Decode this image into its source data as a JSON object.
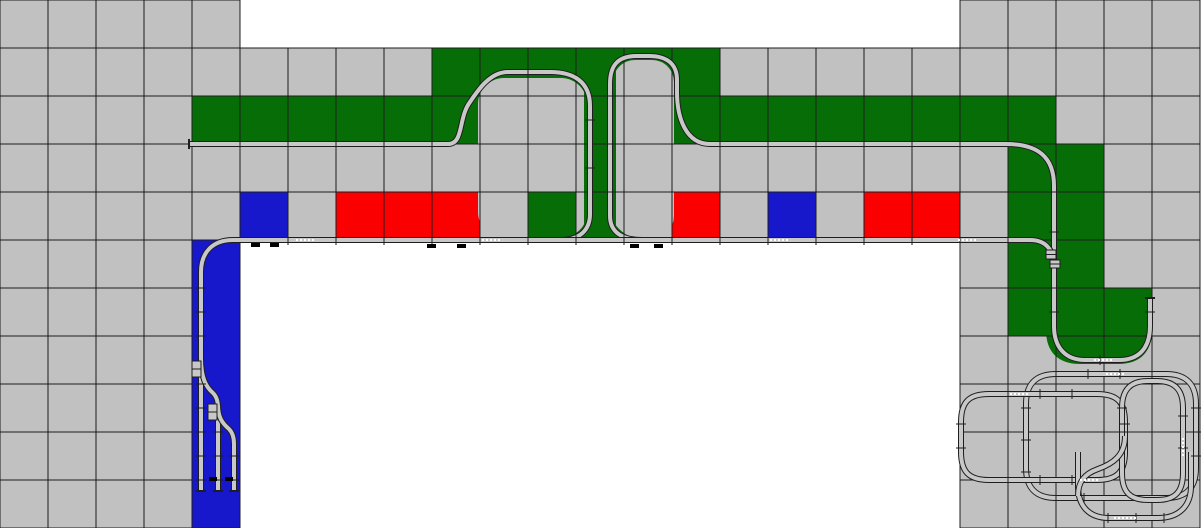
{
  "canvas": {
    "width": 1201,
    "height": 528,
    "cell_size": 48,
    "cols": 25,
    "rows": 11
  },
  "palette": {
    "gray": "#c1c1c1",
    "green": "#076e07",
    "red": "#fa0000",
    "blue": "#1717cc",
    "white": "#ffffff",
    "grid_line": "#1d1d1d",
    "track_dark": "#1e1e1e",
    "track_light": "#c8c8c8",
    "mark_black": "#000000",
    "joint_white": "#ffffff"
  },
  "legend": {
    "G": "gray",
    "N": "green",
    "R": "red",
    "B": "blue",
    "W": "white"
  },
  "grid": [
    "GGGGGWWWWWWWWWWWWWWWGGGGG",
    "GGGGGGGGGNNNNNNGGGGGGGGGG",
    "GGGGNNNNNNGGNNNNNNNNNNGGG",
    "GGGGGGGGGGGGNGGGGGGGGNNGG",
    "GGGGGBGRRRGNNGRGBGRRGNNGG",
    "GGGGBWWWWWWWWWWWWWWWGNNGG",
    "GGGGBWWWWWWWWWWWWWWWGNNNG",
    "GGGGBWWWWWWWWWWWWWWWGGGGG",
    "GGGGBWWWWWWWWWWWWWWWGGGGG",
    "GGGGBWWWWWWWWWWWWWWWGGGGG",
    "GGGGBWWWWWWWWWWWWWWWGGGGG"
  ],
  "overlays": [
    {
      "kind": "rrect",
      "name": "left-loop-interior",
      "x": 478,
      "y": 78,
      "w": 109,
      "h": 160,
      "r": 26,
      "color": "gray"
    },
    {
      "kind": "rrect",
      "name": "right-loop-interior",
      "x": 613,
      "y": 60,
      "w": 61,
      "h": 178,
      "r": 22,
      "color": "gray"
    },
    {
      "kind": "rect",
      "name": "center-green-strip",
      "x": 584,
      "y": 48,
      "w": 32,
      "h": 193,
      "color": "green"
    },
    {
      "kind": "path",
      "name": "funnel-wedge-left",
      "d": "M590,212 C588,224 578,235 560,241 L590,241 Z",
      "color": "green"
    },
    {
      "kind": "path",
      "name": "funnel-wedge-right",
      "d": "M610,212 C612,224 622,235 640,241 L610,241 Z",
      "color": "green"
    },
    {
      "kind": "rect",
      "name": "green-pad-cell",
      "x": 528,
      "y": 192,
      "w": 48,
      "h": 48,
      "color": "green"
    },
    {
      "kind": "path",
      "name": "right-u-green-fill",
      "d": "M1046,288 L1152,288 L1152,330 C1152,352 1140,364 1118,364 L1080,364 C1058,364 1046,352 1046,330 Z",
      "color": "green"
    }
  ],
  "blue_column": {
    "x": 192,
    "y": 240,
    "w": 48,
    "h": 288
  },
  "tracks": [
    {
      "name": "practice-oval-a",
      "d": "M1056,374 L1166,374 C1186,374 1196,384 1196,404 L1196,468 C1196,488 1186,498 1166,498 L1056,498 C1036,498 1026,488 1026,468 L1026,404 C1026,384 1036,374 1056,374 Z"
    },
    {
      "name": "practice-oval-b",
      "d": "M989,394 L1097,394 C1117,394 1125,402 1125,422 L1125,452 C1125,472 1117,480 1097,480 L989,480 C969,480 961,472 961,452 L961,422 C961,402 969,394 989,394 Z"
    },
    {
      "name": "practice-oval-c",
      "d": "M1148,381 L1157,381 C1175,381 1183,390 1183,408 L1183,473 C1183,492 1175,500 1157,500 L1148,500 C1130,500 1122,492 1122,473 L1122,408 C1122,390 1130,381 1148,381 Z"
    },
    {
      "name": "practice-loop-bottom",
      "d": "M1078,452 L1078,486 C1078,506 1089,518 1109,518 L1158,518 C1179,518 1191,506 1191,486 L1191,452"
    },
    {
      "name": "practice-s-curve",
      "d": "M1125,436 C1125,456 1112,464 1098,469 C1084,474 1078,482 1078,496"
    },
    {
      "name": "upper-line-left-loop",
      "d": "M189,144 L448,144 C464,144 458,118 470,102 C478,90 490,72 508,72 L550,72 C574,72 590,82 590,106 L590,214 C590,230 580,240 560,240"
    },
    {
      "name": "upper-line-right-loop",
      "d": "M642,240 C622,240 610,232 610,216 L610,84 C610,64 619,56 637,56 L649,56 C668,56 677,65 677,80 L677,92 C677,118 686,144 710,144 L1006,144 C1038,144 1054,157 1054,186 L1054,326 C1054,348 1066,360 1085,360 L1119,360 C1139,360 1150,348 1150,326 L1150,298"
    },
    {
      "name": "main-line",
      "d": "M233,240 L1030,240 C1046,240 1054,250 1054,267"
    },
    {
      "name": "siding-stub-1",
      "d": "M233,240 C213,240 201,252 201,272 L201,491"
    },
    {
      "name": "siding-stub-2",
      "d": "M201,358 C201,378 206,387 213,393 C217,397 218,402 218,409 L218,491"
    },
    {
      "name": "siding-stub-3",
      "d": "M218,405 C218,417 222,423 229,429 C233,433 234,438 234,444 L234,491"
    }
  ],
  "ticks": [
    {
      "o": "v",
      "y": 144,
      "xs": [
        240,
        288,
        336,
        384,
        432,
        720,
        768,
        816,
        864,
        912,
        960
      ]
    },
    {
      "o": "v",
      "y": 72,
      "xs": [
        528
      ]
    },
    {
      "o": "v",
      "y": 240,
      "xs": [
        288,
        336,
        384,
        432,
        480,
        528,
        576,
        624,
        672,
        720,
        768,
        816,
        864,
        912,
        960,
        1008
      ]
    },
    {
      "o": "h",
      "x": 590,
      "ys": [
        120,
        168
      ]
    },
    {
      "o": "h",
      "x": 610,
      "ys": [
        96,
        144,
        192
      ]
    },
    {
      "o": "h",
      "x": 1054,
      "ys": [
        192,
        232,
        288,
        312
      ]
    },
    {
      "o": "h",
      "x": 1150,
      "ys": [
        312
      ]
    },
    {
      "o": "h",
      "x": 201,
      "ys": [
        288,
        312,
        336,
        384,
        408,
        432,
        456,
        480
      ]
    },
    {
      "o": "h",
      "x": 218,
      "ys": [
        432,
        456,
        480
      ]
    },
    {
      "o": "h",
      "x": 234,
      "ys": [
        456,
        480
      ]
    },
    {
      "o": "v",
      "y": 360,
      "xs": [
        1100
      ]
    },
    {
      "o": "v",
      "y": 374,
      "xs": [
        1056,
        1088,
        1120,
        1152
      ]
    },
    {
      "o": "v",
      "y": 394,
      "xs": [
        1008,
        1040,
        1072
      ]
    },
    {
      "o": "v",
      "y": 480,
      "xs": [
        1008,
        1040,
        1072
      ]
    },
    {
      "o": "v",
      "y": 498,
      "xs": [
        1056,
        1084
      ]
    },
    {
      "o": "v",
      "y": 518,
      "xs": [
        1108,
        1136,
        1164
      ]
    },
    {
      "o": "h",
      "x": 961,
      "ys": [
        424,
        448
      ]
    },
    {
      "o": "h",
      "x": 1026,
      "ys": [
        408,
        440,
        472
      ]
    },
    {
      "o": "h",
      "x": 1196,
      "ys": [
        408,
        432,
        456
      ]
    },
    {
      "o": "h",
      "x": 1122,
      "ys": [
        408,
        432
      ]
    },
    {
      "o": "h",
      "x": 1183,
      "ys": [
        416,
        448
      ]
    },
    {
      "o": "h",
      "x": 1125,
      "ys": [
        424
      ]
    }
  ],
  "endcaps": [
    [
      189,
      139,
      189,
      149
    ],
    [
      1145,
      298,
      1155,
      298
    ],
    [
      196,
      491,
      206,
      491
    ],
    [
      213,
      491,
      223,
      491
    ],
    [
      229,
      491,
      239,
      491
    ]
  ],
  "joints": [
    [
      296,
      240,
      314,
      240
    ],
    [
      482,
      240,
      500,
      240
    ],
    [
      770,
      240,
      788,
      240
    ],
    [
      958,
      240,
      976,
      240
    ],
    [
      1094,
      360,
      1112,
      360
    ],
    [
      1106,
      374,
      1124,
      374
    ],
    [
      1010,
      394,
      1028,
      394
    ],
    [
      1080,
      480,
      1098,
      480
    ],
    [
      1114,
      518,
      1138,
      518
    ],
    [
      1183,
      438,
      1183,
      456
    ]
  ],
  "black_marks": [
    {
      "x": 251,
      "y": 243,
      "w": 9,
      "h": 4
    },
    {
      "x": 270,
      "y": 243,
      "w": 9,
      "h": 4
    },
    {
      "x": 427,
      "y": 244,
      "w": 9,
      "h": 4
    },
    {
      "x": 457,
      "y": 244,
      "w": 9,
      "h": 4
    },
    {
      "x": 630,
      "y": 244,
      "w": 9,
      "h": 4
    },
    {
      "x": 654,
      "y": 244,
      "w": 9,
      "h": 4
    },
    {
      "x": 209,
      "y": 477,
      "w": 8,
      "h": 4
    },
    {
      "x": 225,
      "y": 477,
      "w": 8,
      "h": 4
    }
  ],
  "turnout_icons": [
    {
      "x": 192,
      "y": 361,
      "w": 9,
      "h": 16
    },
    {
      "x": 208,
      "y": 404,
      "w": 9,
      "h": 16
    },
    {
      "x": 1046,
      "y": 250,
      "w": 10,
      "h": 9
    },
    {
      "x": 1050,
      "y": 260,
      "w": 10,
      "h": 8
    }
  ]
}
